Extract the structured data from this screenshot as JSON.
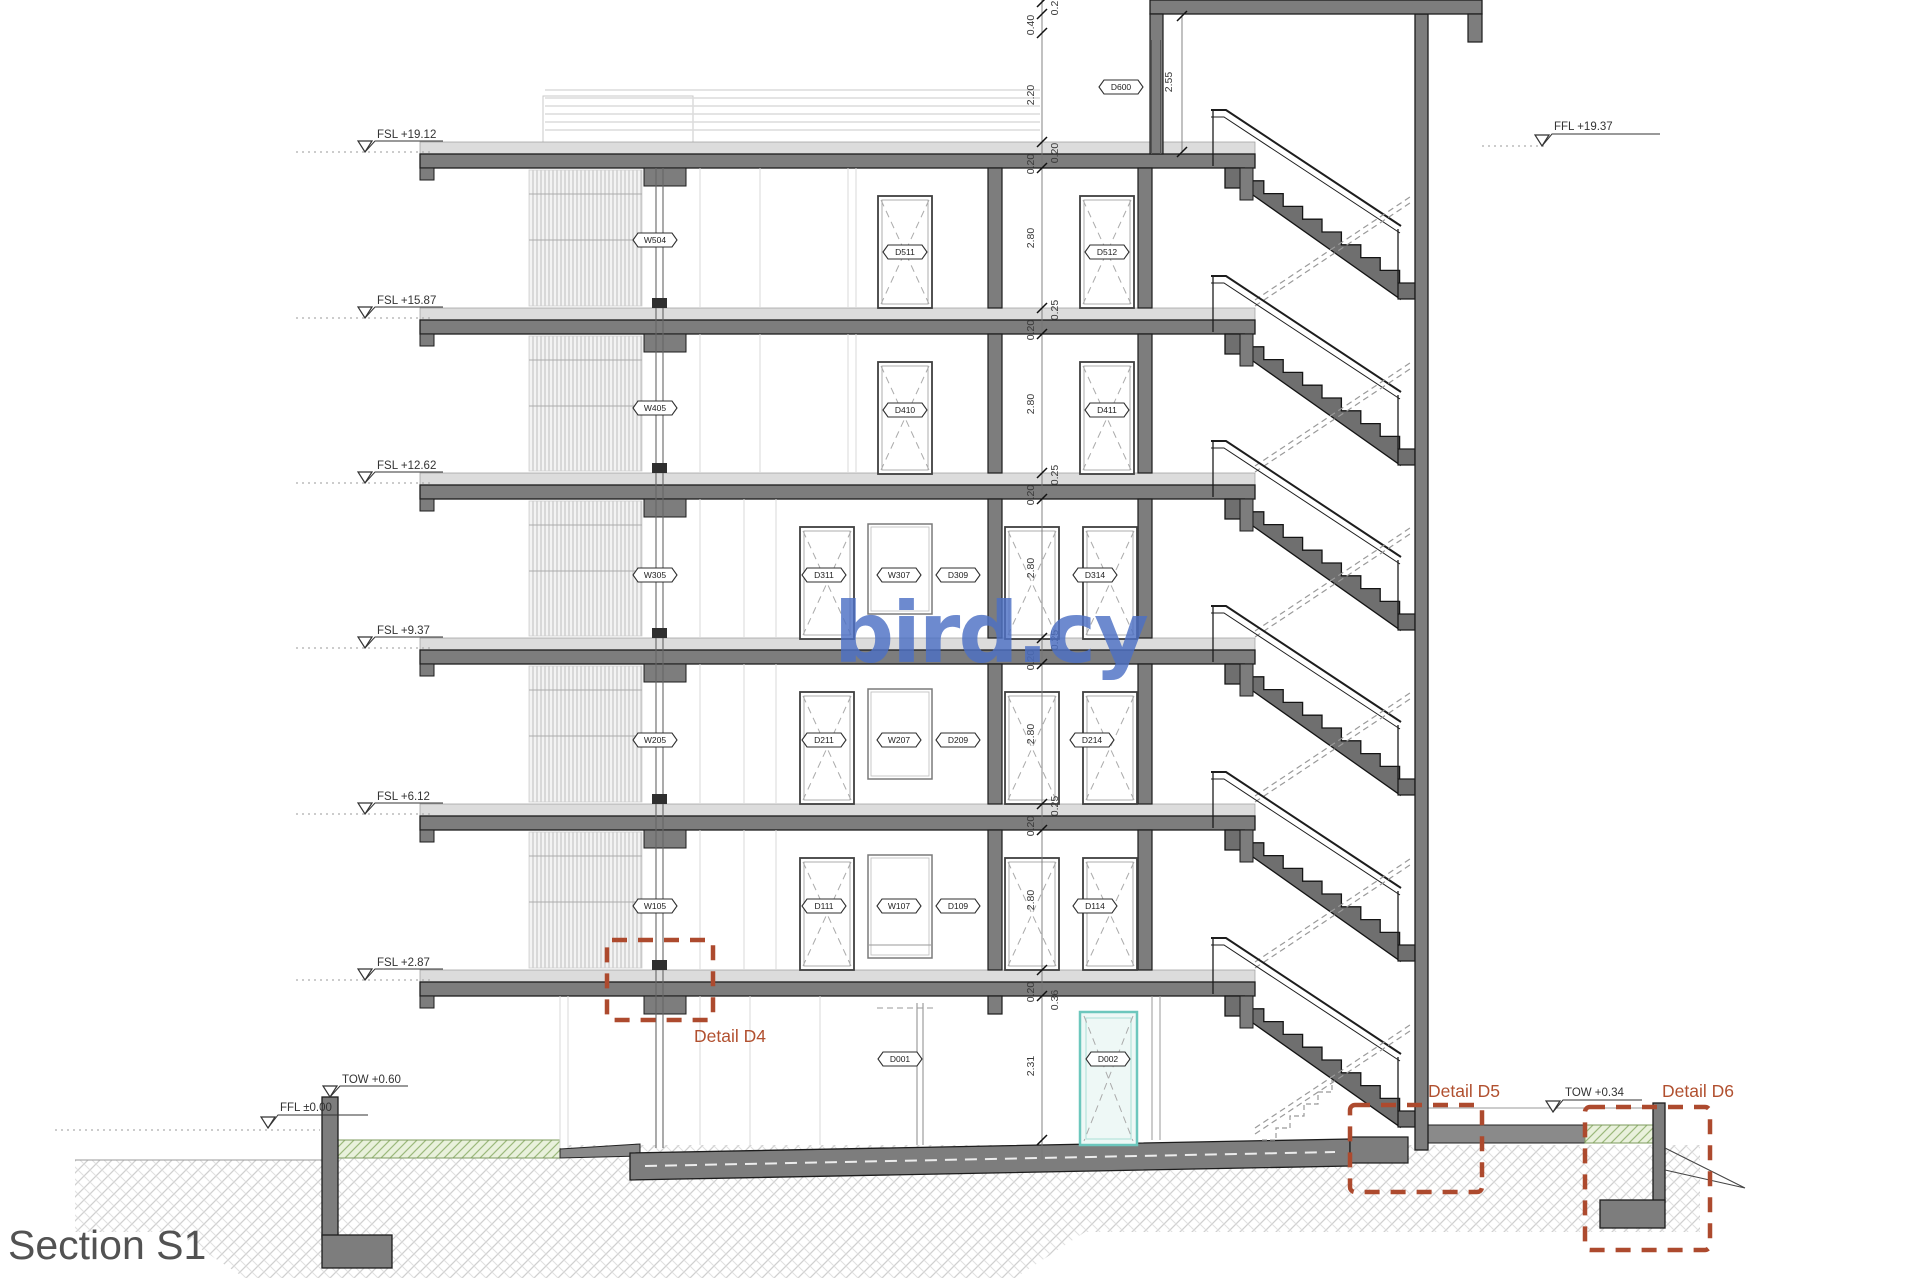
{
  "title": "Section S1",
  "watermark": "bird.cy",
  "levels": {
    "fslRoof": "FSL +19.12",
    "fsl5": "FSL +15.87",
    "fsl4": "FSL +12.62",
    "fsl3": "FSL +9.37",
    "fsl2": "FSL +6.12",
    "fsl1": "FSL +2.87",
    "towLeft": "TOW +0.60",
    "fflGround": "FFL ±0.00",
    "fflStairRoof": "FFL +19.37",
    "towRight": "TOW +0.34"
  },
  "details": {
    "d4": "Detail D4",
    "d5": "Detail D5",
    "d6": "Detail D6"
  },
  "tags": {
    "W504": "W504",
    "W405": "W405",
    "W305": "W305",
    "W205": "W205",
    "W105": "W105",
    "D511": "D511",
    "D512": "D512",
    "D410": "D410",
    "D411": "D411",
    "D311": "D311",
    "W307": "W307",
    "D309": "D309",
    "D314": "D314",
    "D211": "D211",
    "W207": "W207",
    "D209": "D209",
    "D214": "D214",
    "D111": "D111",
    "W107": "W107",
    "D109": "D109",
    "D114": "D114",
    "D600": "D600",
    "D001": "D001",
    "D002": "D002"
  },
  "dims": {
    "h02": "0.2",
    "h040": "0.40",
    "h220": "2.20",
    "h020": "0.20",
    "h025": "0.25",
    "h280": "2.80",
    "h231": "2.31",
    "h036": "0.36",
    "h255": "2.55"
  },
  "colors": {
    "cut_concrete": "#7d7d7d",
    "detail_callout": "#ad4a2e",
    "watermark_blue": "#4d70c4",
    "highlight_door_teal": "#6cc7bd"
  }
}
